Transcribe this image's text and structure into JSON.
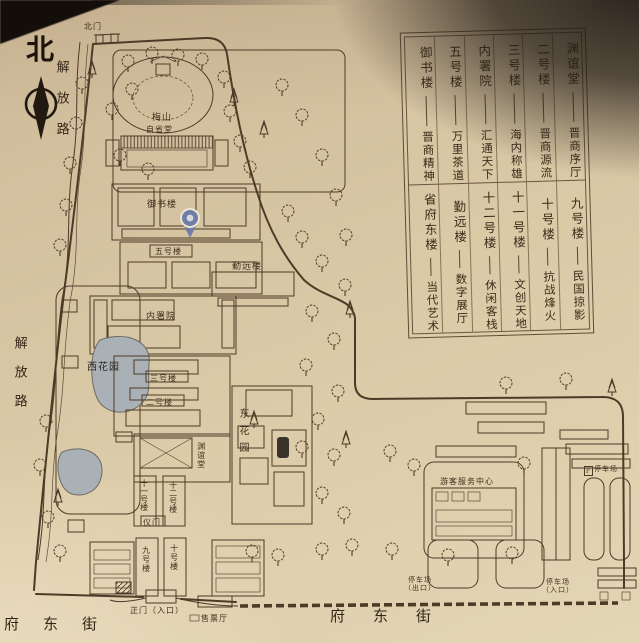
{
  "photo_of": "scenic area guide map board",
  "colors": {
    "paper": "#d6c5a2",
    "ink": "#4e3a27",
    "pond": "#a9b1b6",
    "pin": "#6f7ea6",
    "shadow": "#1e1813"
  },
  "compass": {
    "north": "北"
  },
  "legend": {
    "rows": [
      [
        {
          "name": "御书楼",
          "desc": "晋商精神"
        },
        {
          "name": "五号楼",
          "desc": "万里茶道"
        },
        {
          "name": "内署院",
          "desc": "汇通天下"
        },
        {
          "name": "三号楼",
          "desc": "海内称雄"
        },
        {
          "name": "二号楼",
          "desc": "晋商源流"
        },
        {
          "name": "渊谊堂",
          "desc": "晋商序厅"
        }
      ],
      [
        {
          "name": "省府东楼",
          "desc": "当代艺术"
        },
        {
          "name": "勤远楼",
          "desc": "数字展厅"
        },
        {
          "name": "十二号楼",
          "desc": "休闲客栈"
        },
        {
          "name": "十一号楼",
          "desc": "文创天地"
        },
        {
          "name": "十号楼",
          "desc": "抗战烽火"
        },
        {
          "name": "九号楼",
          "desc": "民国掠影"
        }
      ]
    ]
  },
  "map": {
    "labels": [
      {
        "t": "北门"
      },
      {
        "t": "梅山"
      },
      {
        "t": "自省堂"
      },
      {
        "t": "御书楼"
      },
      {
        "t": "五号楼"
      },
      {
        "t": "勤远楼"
      },
      {
        "t": "内署院"
      },
      {
        "t": "西花园"
      },
      {
        "t": "三号楼"
      },
      {
        "t": "二号楼"
      },
      {
        "t": "渊谊堂"
      },
      {
        "t": "东花园"
      },
      {
        "t": "十一号楼"
      },
      {
        "t": "十二号楼"
      },
      {
        "t": "仪门"
      },
      {
        "t": "九号楼"
      },
      {
        "t": "十号楼"
      },
      {
        "t": "正门（入口）"
      },
      {
        "t": "售票厅"
      },
      {
        "t": "游客服务中心"
      },
      {
        "t": "P"
      },
      {
        "t": "停车场"
      },
      {
        "t": "停车场\n（出口）"
      },
      {
        "t": "停车场\n（入口）"
      },
      {
        "t": "解放路"
      },
      {
        "t": "解放路"
      },
      {
        "t": "府东街"
      },
      {
        "t": "府东街"
      },
      {
        "t": "北"
      }
    ]
  }
}
